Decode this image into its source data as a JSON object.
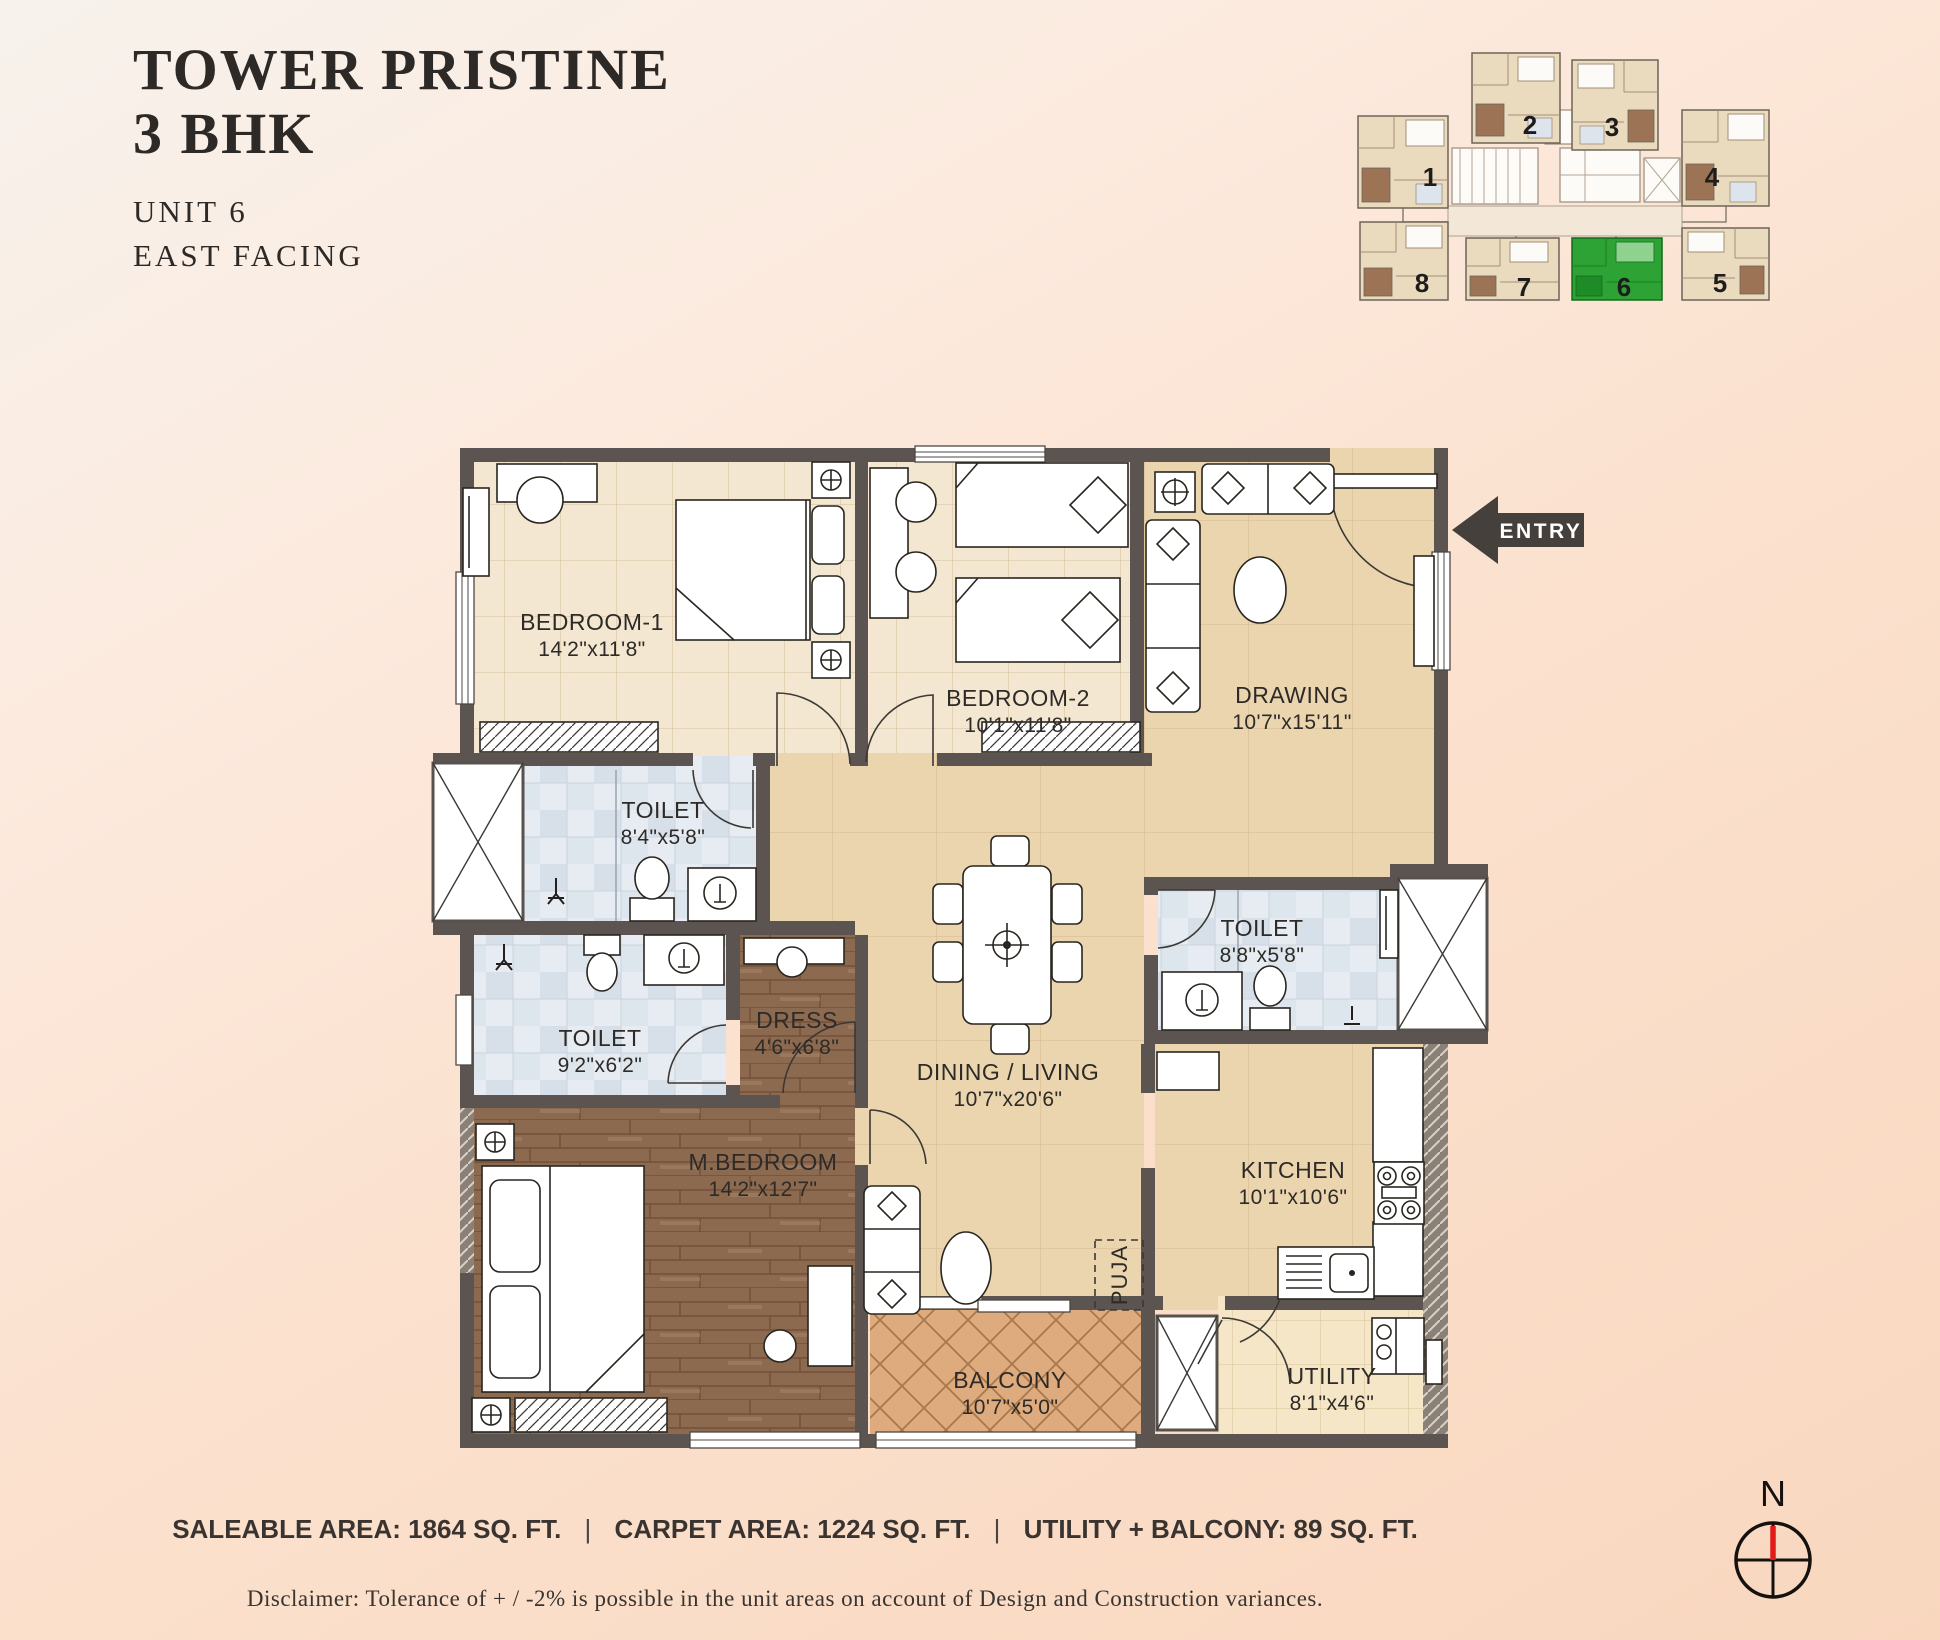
{
  "header": {
    "title_line1": "TOWER PRISTINE",
    "title_line2": "3 BHK",
    "unit": "UNIT 6",
    "facing": "EAST FACING"
  },
  "keyplan": {
    "units": [
      {
        "label": "1"
      },
      {
        "label": "2"
      },
      {
        "label": "3"
      },
      {
        "label": "4"
      },
      {
        "label": "5"
      },
      {
        "label": "6"
      },
      {
        "label": "7"
      },
      {
        "label": "8"
      }
    ],
    "highlighted_unit": "6",
    "highlight_color": "#2ea335"
  },
  "plan": {
    "entry_label": "ENTRY",
    "rooms": [
      {
        "name": "BEDROOM-1",
        "dims": "14'2\"x11'8\""
      },
      {
        "name": "BEDROOM-2",
        "dims": "10'1\"x11'8\""
      },
      {
        "name": "DRAWING",
        "dims": "10'7\"x15'11\""
      },
      {
        "name": "TOILET",
        "dims": "8'4\"x5'8\""
      },
      {
        "name": "TOILET",
        "dims": "9'2\"x6'2\""
      },
      {
        "name": "DRESS",
        "dims": "4'6\"x6'8\""
      },
      {
        "name": "DINING / LIVING",
        "dims": "10'7\"x20'6\""
      },
      {
        "name": "TOILET",
        "dims": "8'8\"x5'8\""
      },
      {
        "name": "M.BEDROOM",
        "dims": "14'2\"x12'7\""
      },
      {
        "name": "KITCHEN",
        "dims": "10'1\"x10'6\""
      },
      {
        "name": "PUJA"
      },
      {
        "name": "BALCONY",
        "dims": "10'7\"x5'0\""
      },
      {
        "name": "UTILITY",
        "dims": "8'1\"x4'6\""
      }
    ]
  },
  "stats": {
    "saleable": "SALEABLE AREA: 1864 SQ. FT.",
    "carpet": "CARPET AREA: 1224 SQ. FT.",
    "utility_balcony": "UTILITY + BALCONY: 89 SQ. FT.",
    "separator": "|"
  },
  "disclaimer": "Disclaimer: Tolerance of + / -2% is possible in the unit areas on account of Design and Construction variances.",
  "compass": {
    "north_label": "N"
  }
}
